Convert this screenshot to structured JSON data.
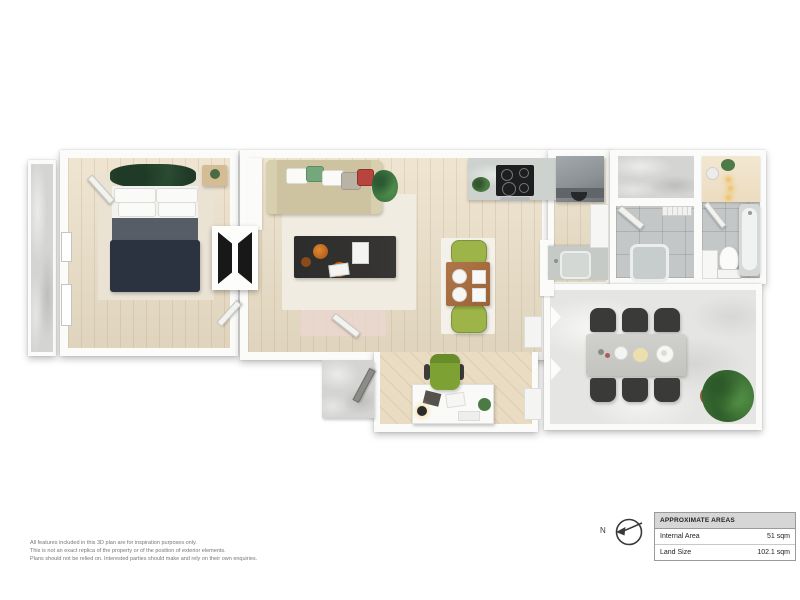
{
  "compass": {
    "label": "N"
  },
  "areas_table": {
    "title": "APPROXIMATE AREAS",
    "rows": [
      {
        "label": "Internal Area",
        "value": "51 sqm"
      },
      {
        "label": "Land Size",
        "value": "102.1 sqm"
      }
    ]
  },
  "disclaimer": {
    "line1": "All features included in this 3D plan are for inspiration purposes only.",
    "line2": "This is not an exact replica of the property or of the position of exterior elements.",
    "line3": "Plans should not be relied on. Interested parties should make and rely on their own enquiries."
  },
  "floorplan": {
    "style": "3d-top-down-render",
    "rooms": [
      "balcony",
      "bedroom",
      "hall",
      "living-room",
      "dining-area",
      "kitchen",
      "study-nook",
      "entry",
      "storage",
      "laundry",
      "bathroom",
      "courtyard"
    ],
    "colors": {
      "wood_floor": "#ebdfc7",
      "concrete": "#d4d4d2",
      "tile": "#c4c7c7",
      "courtyard_paving": "#e5e5e3",
      "bed_blanket": "#2a333f",
      "sofa": "#cdc3a0",
      "coffee_table": "#2c2c2c",
      "dining_table": "#a86f41",
      "accent_green": "#8fae3e",
      "plant_green": "#3d6e35",
      "outdoor_chairs": "#3a3a38"
    }
  }
}
